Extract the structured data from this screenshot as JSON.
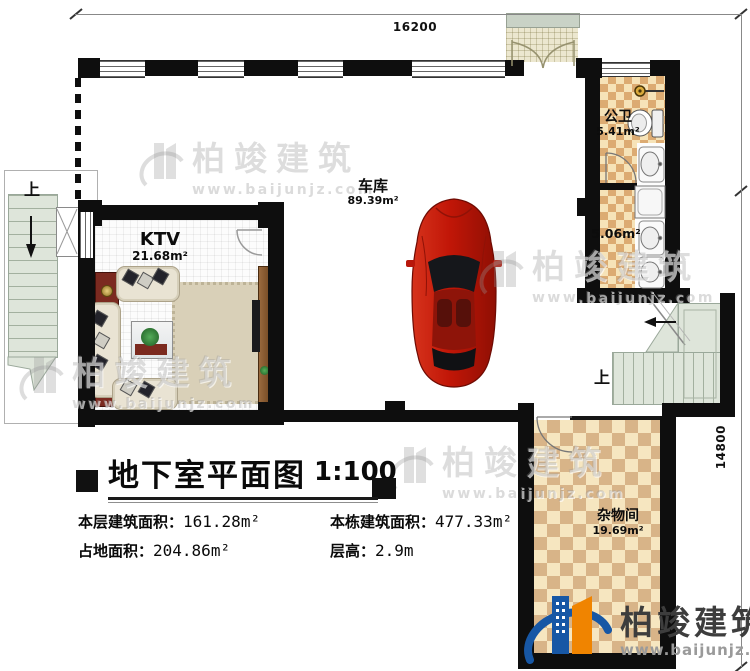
{
  "dimensions": {
    "top": "16200",
    "right": "14800"
  },
  "rooms": {
    "garage": {
      "name": "车库",
      "area": "89.39m²"
    },
    "ktv": {
      "name": "KTV",
      "area": "21.68m²"
    },
    "public_bath": {
      "name": "公卫",
      "area": "5.41m²"
    },
    "wash_area": {
      "area": "5.06m²"
    },
    "storage": {
      "name": "杂物间",
      "area": "19.69m²"
    }
  },
  "stairs": {
    "left_up": "上",
    "right_up": "上"
  },
  "titleblock": {
    "title": "地下室平面图",
    "scale": "1:100",
    "stats": [
      {
        "label": "本层建筑面积：",
        "value": "161.28m²"
      },
      {
        "label": "本栋建筑面积：",
        "value": "477.33m²"
      },
      {
        "label": "占地面积：",
        "value": "204.86m²"
      },
      {
        "label": "层高：",
        "value": "2.9m"
      }
    ]
  },
  "branding": {
    "watermark_brand": "柏竣建筑",
    "watermark_url": "www.baijunjz.com",
    "logo_brand": "柏竣建筑",
    "logo_url": "www.baijunjz.com"
  },
  "colors": {
    "wall": "#0e0e0e",
    "tile_light": "#f6e3b8",
    "tile_dark": "#dcab72",
    "stair_green": "#dee5da",
    "logo_blue": "#1757a5",
    "logo_orange": "#f08400",
    "car_red": "#c11607"
  }
}
